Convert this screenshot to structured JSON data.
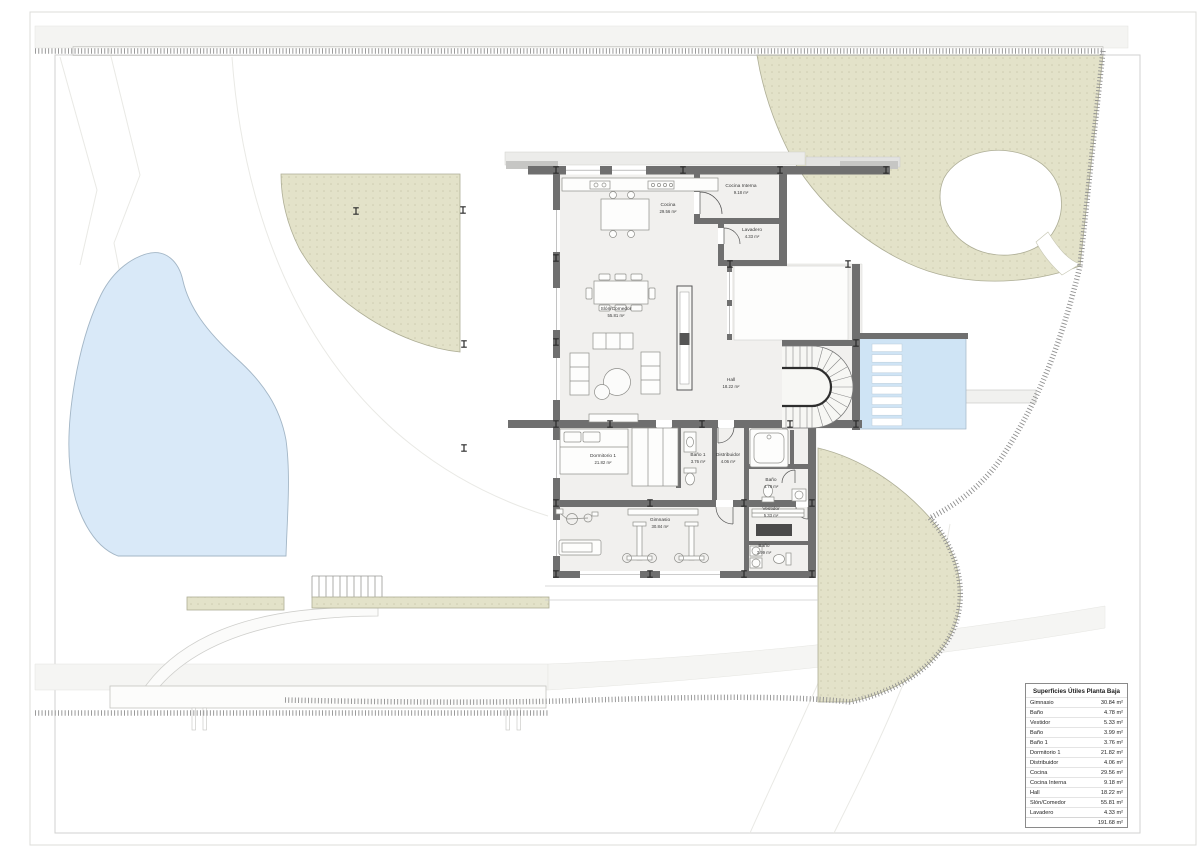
{
  "plan": {
    "rooms": {
      "cocina": {
        "name": "Cocina",
        "area": "29.56 m²"
      },
      "cocina_interna": {
        "name": "Cocina Interna",
        "area": "9.18 m²"
      },
      "lavadero": {
        "name": "Lavadero",
        "area": "4.33 m²"
      },
      "salon": {
        "name": "Slón/Comedor",
        "area": "55.81 m²"
      },
      "hall": {
        "name": "Hall",
        "area": "18.22 m²"
      },
      "dormitorio": {
        "name": "Dormitorio 1",
        "area": "21.82 m²"
      },
      "bano1": {
        "name": "Baño 1",
        "area": "3.76 m²"
      },
      "distribuidor": {
        "name": "Distribuidor",
        "area": "4.06 m²"
      },
      "bano_suite": {
        "name": "Baño",
        "area": "4.78 m²"
      },
      "gimnasio": {
        "name": "Gimnasio",
        "area": "30.84 m²"
      },
      "vestidor": {
        "name": "Vestidor",
        "area": "5.33 m²"
      },
      "bano_gym": {
        "name": "Baño",
        "area": "3.99 m²"
      }
    }
  },
  "area_table": {
    "title": "Superficies Útiles Planta Baja",
    "rows": [
      {
        "label": "Gimnasio",
        "value": "30.84 m²"
      },
      {
        "label": "Baño",
        "value": "4.78 m²"
      },
      {
        "label": "Vestidor",
        "value": "5.33 m²"
      },
      {
        "label": "Baño",
        "value": "3.99 m²"
      },
      {
        "label": "Baño 1",
        "value": "3.76 m²"
      },
      {
        "label": "Dormitorio 1",
        "value": "21.82 m²"
      },
      {
        "label": "Distribuidor",
        "value": "4.06 m²"
      },
      {
        "label": "Cocina",
        "value": "29.56 m²"
      },
      {
        "label": "Cocina Interna",
        "value": "9.18 m²"
      },
      {
        "label": "Hall",
        "value": "18.22 m²"
      },
      {
        "label": "Slón/Comedor",
        "value": "55.81 m²"
      },
      {
        "label": "Lavadero",
        "value": "4.33 m²"
      }
    ],
    "total_value": "191.68 m²"
  },
  "colors": {
    "wall": "#6f6f6f",
    "landscape_green": "#e3e2c9",
    "pond_blue": "#d9e9f8",
    "pool_blue": "#cfe4f5"
  }
}
